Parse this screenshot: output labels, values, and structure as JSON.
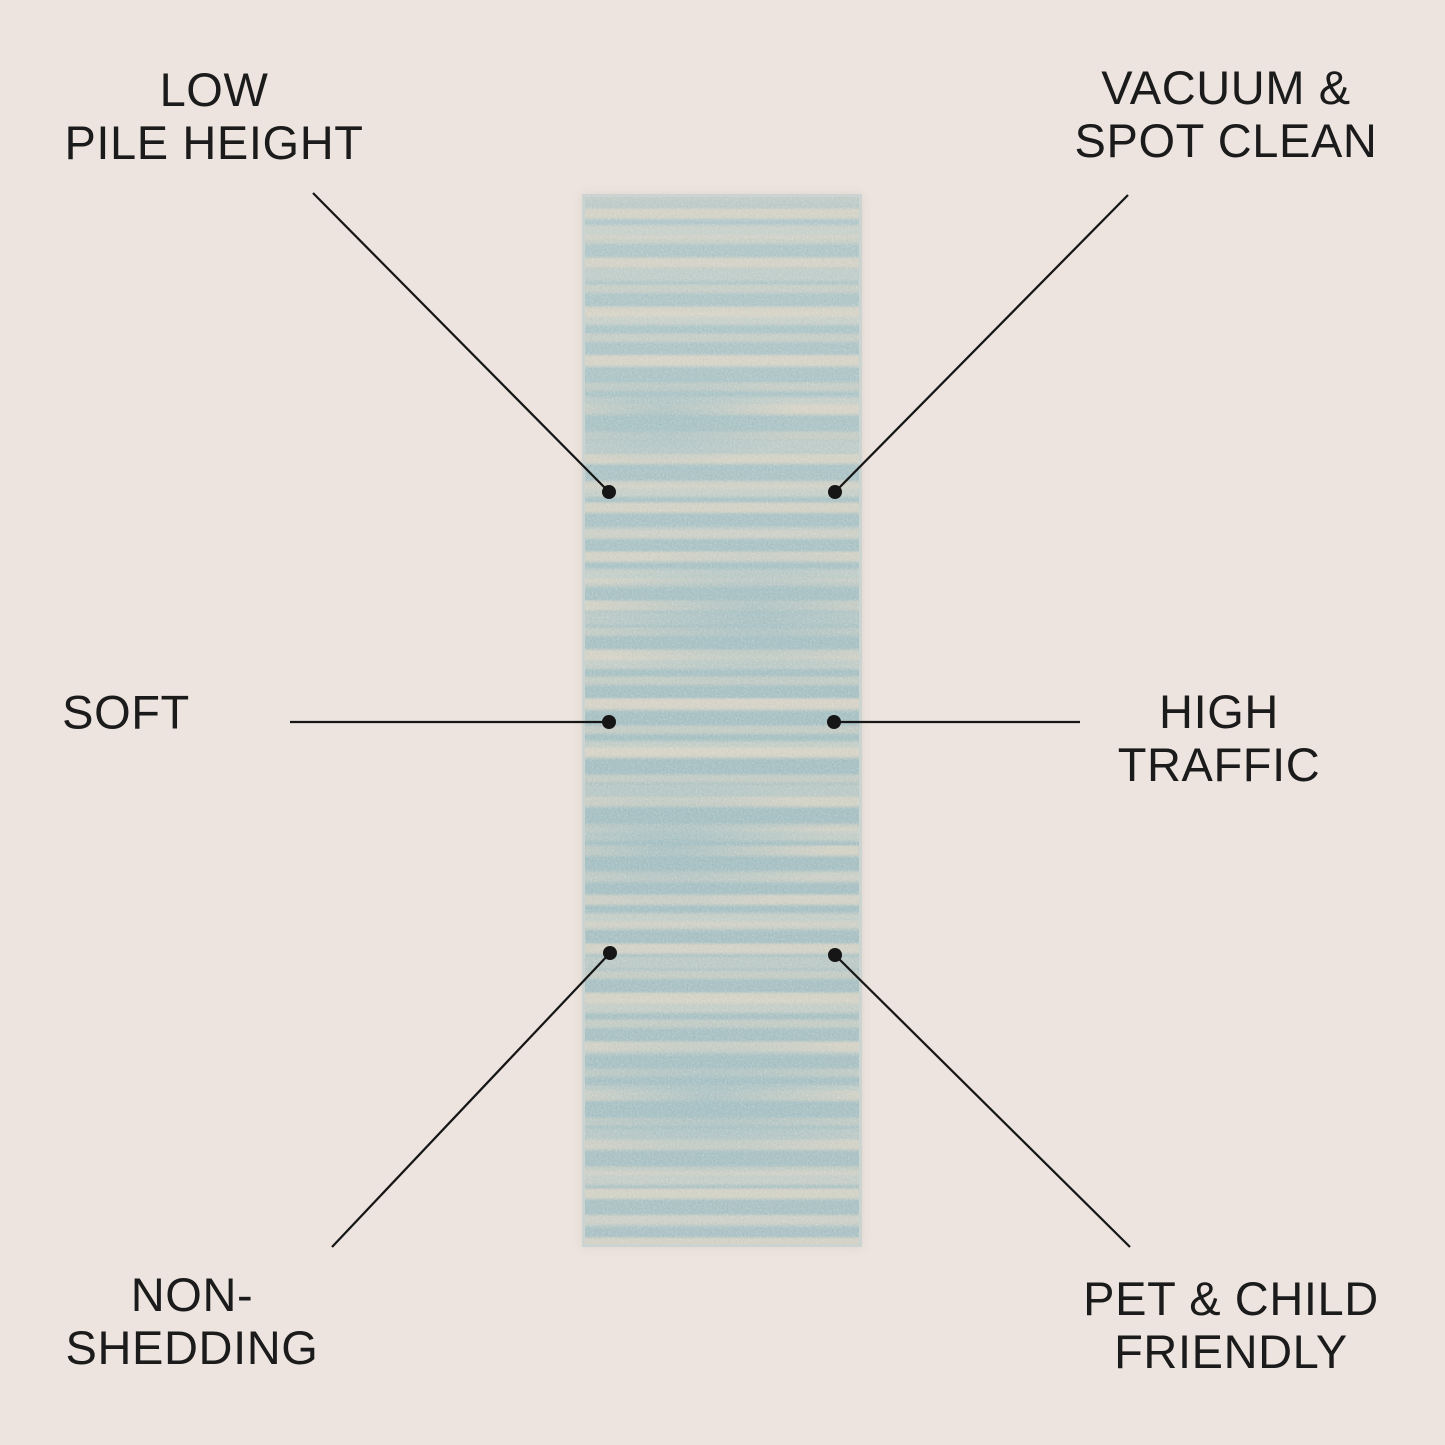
{
  "canvas": {
    "width": 1445,
    "height": 1445,
    "background_color": "#ede4df",
    "text_color": "#1b1b1b",
    "line_color": "#161616"
  },
  "rug": {
    "description": "blue striped runner rug",
    "base_color": "#a3bfc1",
    "stripe_color": "#d8d2c3",
    "edge_color": "#ccd4d1"
  },
  "callouts": [
    {
      "id": "low-pile-height",
      "line1": "LOW",
      "line2": "PILE HEIGHT"
    },
    {
      "id": "vacuum-spot-clean",
      "line1": "VACUUM &",
      "line2": "SPOT CLEAN"
    },
    {
      "id": "soft",
      "line1": "SOFT",
      "line2": ""
    },
    {
      "id": "high-traffic",
      "line1": "HIGH",
      "line2": "TRAFFIC"
    },
    {
      "id": "non-shedding",
      "line1": "NON-",
      "line2": "SHEDDING"
    },
    {
      "id": "pet-child-friendly",
      "line1": "PET & CHILD",
      "line2": "FRIENDLY"
    }
  ]
}
